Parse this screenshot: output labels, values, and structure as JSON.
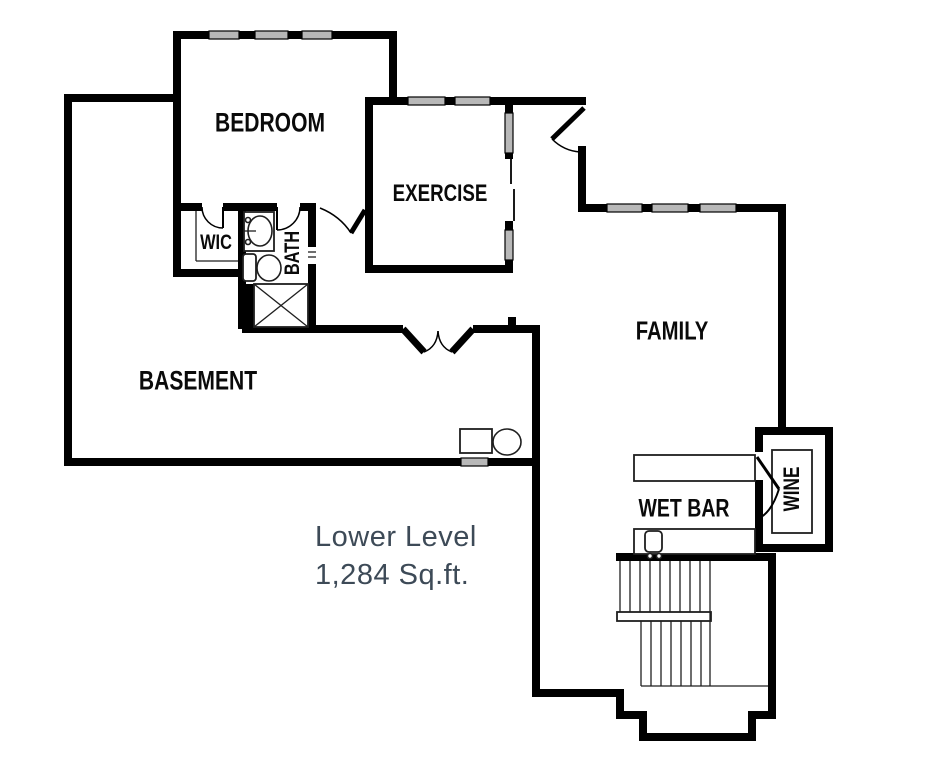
{
  "title": "Lower Level Floor Plan",
  "caption": {
    "lines": [
      "Lower Level",
      "1,284 Sq.ft."
    ],
    "color": "#3d4a57"
  },
  "rooms": [
    {
      "id": "bedroom",
      "label": "BEDROOM",
      "x": 270,
      "y": 123,
      "size": 27,
      "rotate": 0
    },
    {
      "id": "exercise",
      "label": "EXERCISE",
      "x": 440,
      "y": 194,
      "size": 24,
      "rotate": 0
    },
    {
      "id": "wic",
      "label": "WIC",
      "x": 216,
      "y": 243,
      "size": 21,
      "rotate": 0
    },
    {
      "id": "bath",
      "label": "BATH",
      "x": 293,
      "y": 253,
      "size": 21,
      "rotate": -90
    },
    {
      "id": "basement",
      "label": "BASEMENT",
      "x": 198,
      "y": 381,
      "size": 27,
      "rotate": 0
    },
    {
      "id": "family",
      "label": "FAMILY",
      "x": 672,
      "y": 331,
      "size": 26,
      "rotate": 0
    },
    {
      "id": "wet-bar",
      "label": "WET BAR",
      "x": 684,
      "y": 509,
      "size": 25,
      "rotate": 0
    },
    {
      "id": "wine",
      "label": "WINE",
      "x": 792,
      "y": 489,
      "size": 22,
      "rotate": -90
    }
  ],
  "plan": {
    "width": 935,
    "height": 768,
    "colors": {
      "wall": "#000000",
      "window": "#b8b8b8",
      "line": "#1f1f1f",
      "bg": "#ffffff"
    },
    "walls": [
      [
        64,
        94,
        113,
        8
      ],
      [
        64,
        94,
        8,
        372
      ],
      [
        64,
        458,
        476,
        8
      ],
      [
        173,
        31,
        224,
        8
      ],
      [
        173,
        31,
        8,
        246
      ],
      [
        389,
        31,
        8,
        70
      ],
      [
        365,
        97,
        148,
        8
      ],
      [
        365,
        97,
        8,
        176
      ],
      [
        365,
        265,
        148,
        8
      ],
      [
        505,
        97,
        8,
        62
      ],
      [
        505,
        221,
        8,
        52
      ],
      [
        513,
        97,
        73,
        8
      ],
      [
        578,
        146,
        8,
        66
      ],
      [
        578,
        204,
        208,
        8
      ],
      [
        778,
        204,
        8,
        224
      ],
      [
        238,
        203,
        8,
        126
      ],
      [
        173,
        203,
        29,
        8
      ],
      [
        223,
        203,
        54,
        8
      ],
      [
        300,
        203,
        16,
        8
      ],
      [
        308,
        203,
        8,
        44
      ],
      [
        308,
        264,
        8,
        65
      ],
      [
        173,
        269,
        73,
        8
      ],
      [
        246,
        284,
        8,
        45
      ],
      [
        242,
        325,
        161,
        8
      ],
      [
        473,
        325,
        67,
        8
      ],
      [
        532,
        325,
        8,
        372
      ],
      [
        532,
        689,
        92,
        8
      ],
      [
        616,
        689,
        8,
        30
      ],
      [
        616,
        711,
        31,
        8
      ],
      [
        639,
        711,
        8,
        30
      ],
      [
        639,
        733,
        117,
        8
      ],
      [
        748,
        711,
        8,
        30
      ],
      [
        748,
        711,
        28,
        8
      ],
      [
        768,
        553,
        8,
        166
      ],
      [
        616,
        553,
        160,
        8
      ],
      [
        755,
        427,
        78,
        8
      ],
      [
        825,
        427,
        8,
        125
      ],
      [
        755,
        544,
        78,
        8
      ],
      [
        755,
        427,
        8,
        25
      ],
      [
        755,
        480,
        8,
        72
      ],
      [
        508,
        317,
        8,
        8
      ]
    ],
    "windows": [
      [
        209,
        31,
        30,
        8
      ],
      [
        255,
        31,
        33,
        8
      ],
      [
        302,
        31,
        30,
        8
      ],
      [
        408,
        97,
        37,
        8
      ],
      [
        455,
        97,
        35,
        8
      ],
      [
        505,
        113,
        8,
        40
      ],
      [
        505,
        230,
        8,
        30
      ],
      [
        607,
        204,
        35,
        8
      ],
      [
        652,
        204,
        36,
        8
      ],
      [
        700,
        204,
        36,
        8
      ],
      [
        461,
        458,
        27,
        8
      ]
    ],
    "thin_rects": [
      {
        "r": [
          244,
          212,
          30,
          39
        ],
        "rx": 0
      },
      {
        "r": [
          243,
          254,
          13,
          27
        ],
        "rx": 3
      },
      {
        "r": [
          254,
          284,
          54,
          43
        ],
        "rx": 0
      },
      {
        "r": [
          460,
          429,
          32,
          24
        ],
        "rx": 0
      },
      {
        "r": [
          634,
          455,
          121,
          26
        ],
        "rx": 0
      },
      {
        "r": [
          634,
          529,
          121,
          25
        ],
        "rx": 0
      },
      {
        "r": [
          645,
          531,
          17,
          21
        ],
        "rx": 4
      },
      {
        "r": [
          772,
          450,
          40,
          83
        ],
        "rx": 0
      },
      {
        "r": [
          617,
          612,
          94,
          9
        ],
        "rx": 0
      }
    ],
    "ellipses": [
      {
        "c": [
          260,
          231
        ],
        "r": [
          12,
          15
        ]
      },
      {
        "c": [
          269,
          268
        ],
        "r": [
          12,
          13
        ]
      },
      {
        "c": [
          507,
          442
        ],
        "r": [
          14,
          13
        ]
      },
      {
        "c": [
          248,
          220
        ],
        "r": [
          2.5,
          2.5
        ]
      },
      {
        "c": [
          248,
          242
        ],
        "r": [
          2.5,
          2.5
        ]
      },
      {
        "c": [
          650,
          556
        ],
        "r": [
          2.5,
          2.5
        ]
      },
      {
        "c": [
          659,
          556
        ],
        "r": [
          2.5,
          2.5
        ]
      }
    ],
    "lines": [
      [
        254,
        284,
        308,
        327
      ],
      [
        254,
        327,
        308,
        284
      ],
      [
        196,
        211,
        196,
        261
      ],
      [
        196,
        261,
        238,
        261
      ],
      [
        244,
        231,
        256,
        231
      ],
      [
        308,
        252,
        316,
        252
      ],
      [
        308,
        257,
        316,
        257
      ],
      [
        710,
        561,
        710,
        686
      ],
      [
        641,
        686,
        768,
        686
      ],
      [
        620,
        561,
        620,
        612
      ],
      [
        630,
        561,
        630,
        612
      ],
      [
        640,
        561,
        640,
        612
      ],
      [
        650,
        561,
        650,
        612
      ],
      [
        660,
        561,
        660,
        612
      ],
      [
        670,
        561,
        670,
        612
      ],
      [
        680,
        561,
        680,
        612
      ],
      [
        690,
        561,
        690,
        612
      ],
      [
        700,
        561,
        700,
        612
      ],
      [
        641,
        621,
        641,
        686
      ],
      [
        651,
        621,
        651,
        686
      ],
      [
        661,
        621,
        661,
        686
      ],
      [
        671,
        621,
        671,
        686
      ],
      [
        681,
        621,
        681,
        686
      ],
      [
        691,
        621,
        691,
        686
      ],
      [
        701,
        621,
        701,
        686
      ]
    ],
    "paths": [
      {
        "d": "M223,228 A21,21 0 0 1 202,207",
        "w": 1.5
      },
      {
        "d": "M223,207 L223,228",
        "w": 2
      },
      {
        "d": "M277,230 A23,23 0 0 0 300,207",
        "w": 1.5
      },
      {
        "d": "M277,207 L277,230",
        "w": 2
      },
      {
        "d": "M320,208 Q340,216 351,233",
        "w": 1.5
      },
      {
        "d": "M351,233 L365,210",
        "w": 5
      },
      {
        "d": "M584,108 L552,139",
        "w": 5
      },
      {
        "d": "M552,139 A44,44 0 0 0 580,152",
        "w": 1.5
      },
      {
        "d": "M403,329 L424,352",
        "w": 7
      },
      {
        "d": "M473,329 L452,352",
        "w": 7
      },
      {
        "d": "M424,352 Q437,347 438,331",
        "w": 1.5
      },
      {
        "d": "M452,352 Q439,347 438,331",
        "w": 1.5
      },
      {
        "d": "M511,158 L511,184",
        "w": 1.8
      },
      {
        "d": "M514,189 L514,221",
        "w": 1.8
      },
      {
        "d": "M757,457 L779,489",
        "w": 3
      },
      {
        "d": "M779,489 Q771,514 757,519",
        "w": 2
      }
    ]
  }
}
